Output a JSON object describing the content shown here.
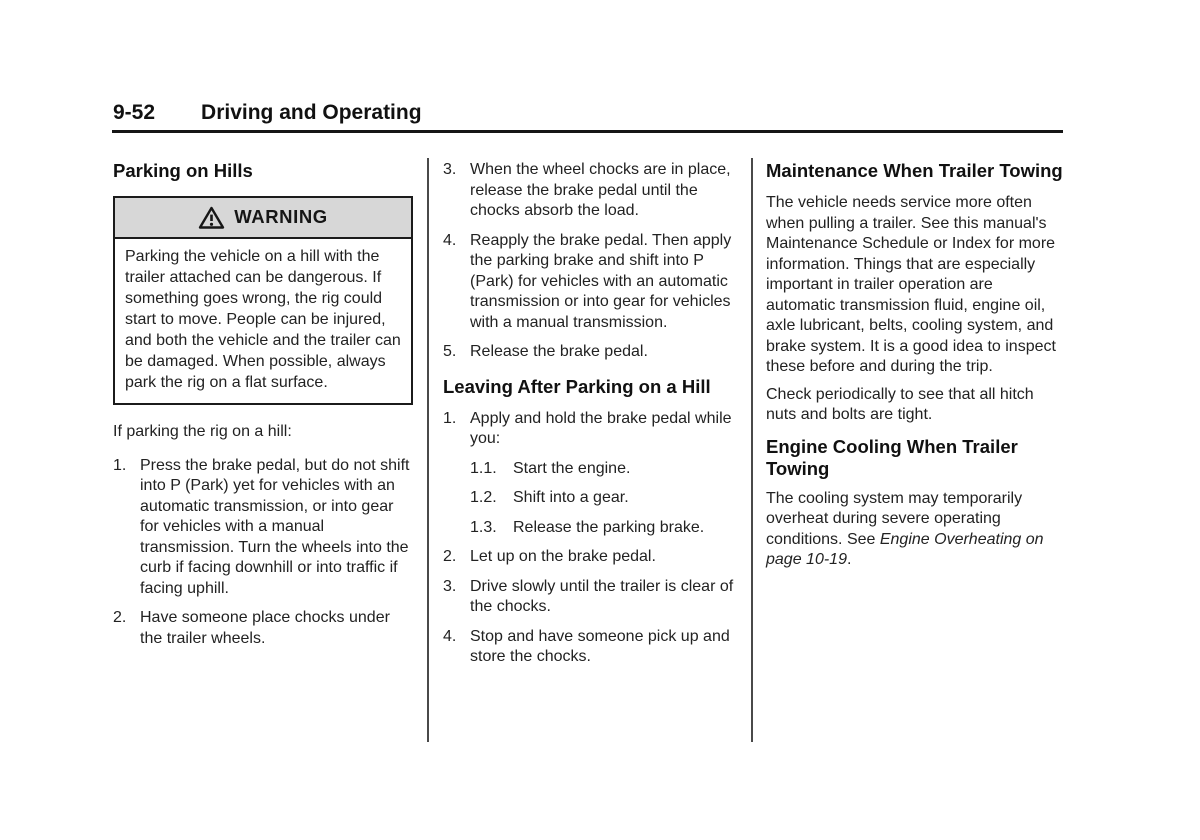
{
  "page_header": {
    "page_number": "9-52",
    "chapter_title": "Driving and Operating"
  },
  "left_column": {
    "section_heading": "Parking on Hills",
    "warning_box": {
      "icon": "warning-triangle-icon",
      "label": "WARNING",
      "body": "Parking the vehicle on a hill with the trailer attached can be dangerous. If something goes wrong, the rig could start to move. People can be injured, and both the vehicle and the trailer can be damaged. When possible, always park the rig on a flat surface."
    },
    "intro": "If parking the rig on a hill:",
    "steps": [
      {
        "num": "1.",
        "text": "Press the brake pedal, but do not shift into P (Park) yet for vehicles with an automatic transmission, or into gear for vehicles with a manual transmission. Turn the wheels into the curb if facing downhill or into traffic if facing uphill."
      },
      {
        "num": "2.",
        "text": "Have someone place chocks under the trailer wheels."
      }
    ]
  },
  "middle_column": {
    "steps_continued": [
      {
        "num": "3.",
        "text": "When the wheel chocks are in place, release the brake pedal until the chocks absorb the load."
      },
      {
        "num": "4.",
        "text": "Reapply the brake pedal. Then apply the parking brake and shift into P (Park) for vehicles with an automatic transmission or into gear for vehicles with a manual transmission."
      },
      {
        "num": "5.",
        "text": "Release the brake pedal."
      }
    ],
    "section_heading": "Leaving After Parking on a Hill",
    "leaving_steps": [
      {
        "num": "1.",
        "text": "Apply and hold the brake pedal while you:",
        "substeps": [
          {
            "num": "1.1.",
            "text": "Start the engine."
          },
          {
            "num": "1.2.",
            "text": "Shift into a gear."
          },
          {
            "num": "1.3.",
            "text": "Release the parking brake."
          }
        ]
      },
      {
        "num": "2.",
        "text": "Let up on the brake pedal."
      },
      {
        "num": "3.",
        "text": "Drive slowly until the trailer is clear of the chocks."
      },
      {
        "num": "4.",
        "text": "Stop and have someone pick up and store the chocks."
      }
    ]
  },
  "right_column": {
    "maintenance_heading": "Maintenance When Trailer Towing",
    "maintenance_para": "The vehicle needs service more often when pulling a trailer. See this manual's Maintenance Schedule or Index for more information. Things that are especially important in trailer operation are automatic transmission fluid, engine oil, axle lubricant, belts, cooling system, and brake system. It is a good idea to inspect these before and during the trip.",
    "hitch_para": "Check periodically to see that all hitch nuts and bolts are tight.",
    "cooling_heading": "Engine Cooling When Trailer Towing",
    "cooling_para": {
      "before": "The cooling system may temporarily overheat during severe operating conditions. See ",
      "italic": "Engine Overheating on page 10-19",
      "after": "."
    }
  },
  "colors": {
    "background": "#ffffff",
    "text": "#222222",
    "heading": "#111111",
    "header_rule": "#151515",
    "column_divider": "#4a4a4a",
    "warning_border": "#1b1b1b",
    "warning_band": "#d7d7d7"
  }
}
